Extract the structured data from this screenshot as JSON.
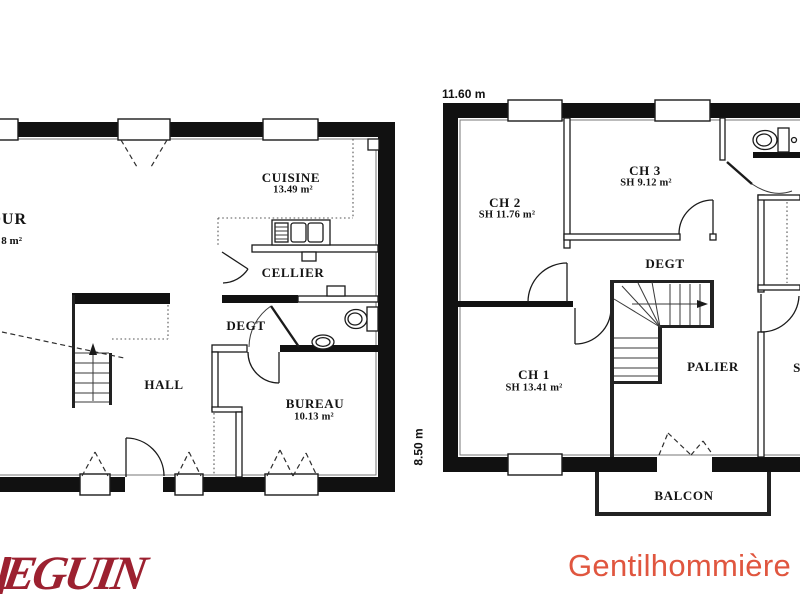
{
  "branding": {
    "logo_fragment": "EGUIN",
    "logo_color": "#9c2130",
    "model_name": "Gentilhommière",
    "model_color": "#e0563f"
  },
  "ground_floor": {
    "sejour_name_fragment": "OUR",
    "sejour_area_fragment": "8 m²",
    "cuisine_name": "CUISINE",
    "cuisine_area": "13.49 m²",
    "cellier_name": "CELLIER",
    "degt_name": "DEGT",
    "hall_name": "HALL",
    "bureau_name": "BUREAU",
    "bureau_area": "10.13 m²"
  },
  "first_floor": {
    "width_dim": "11.60 m",
    "depth_dim": "8.50 m",
    "ch1_name": "CH 1",
    "ch1_area": "SH 13.41 m²",
    "ch2_name": "CH 2",
    "ch2_area": "SH 11.76 m²",
    "ch3_name": "CH 3",
    "ch3_area": "SH 9.12 m²",
    "degt_name": "DEGT",
    "palier_name": "PALIER",
    "room_right_fragment": "S",
    "balcon_name": "BALCON"
  }
}
